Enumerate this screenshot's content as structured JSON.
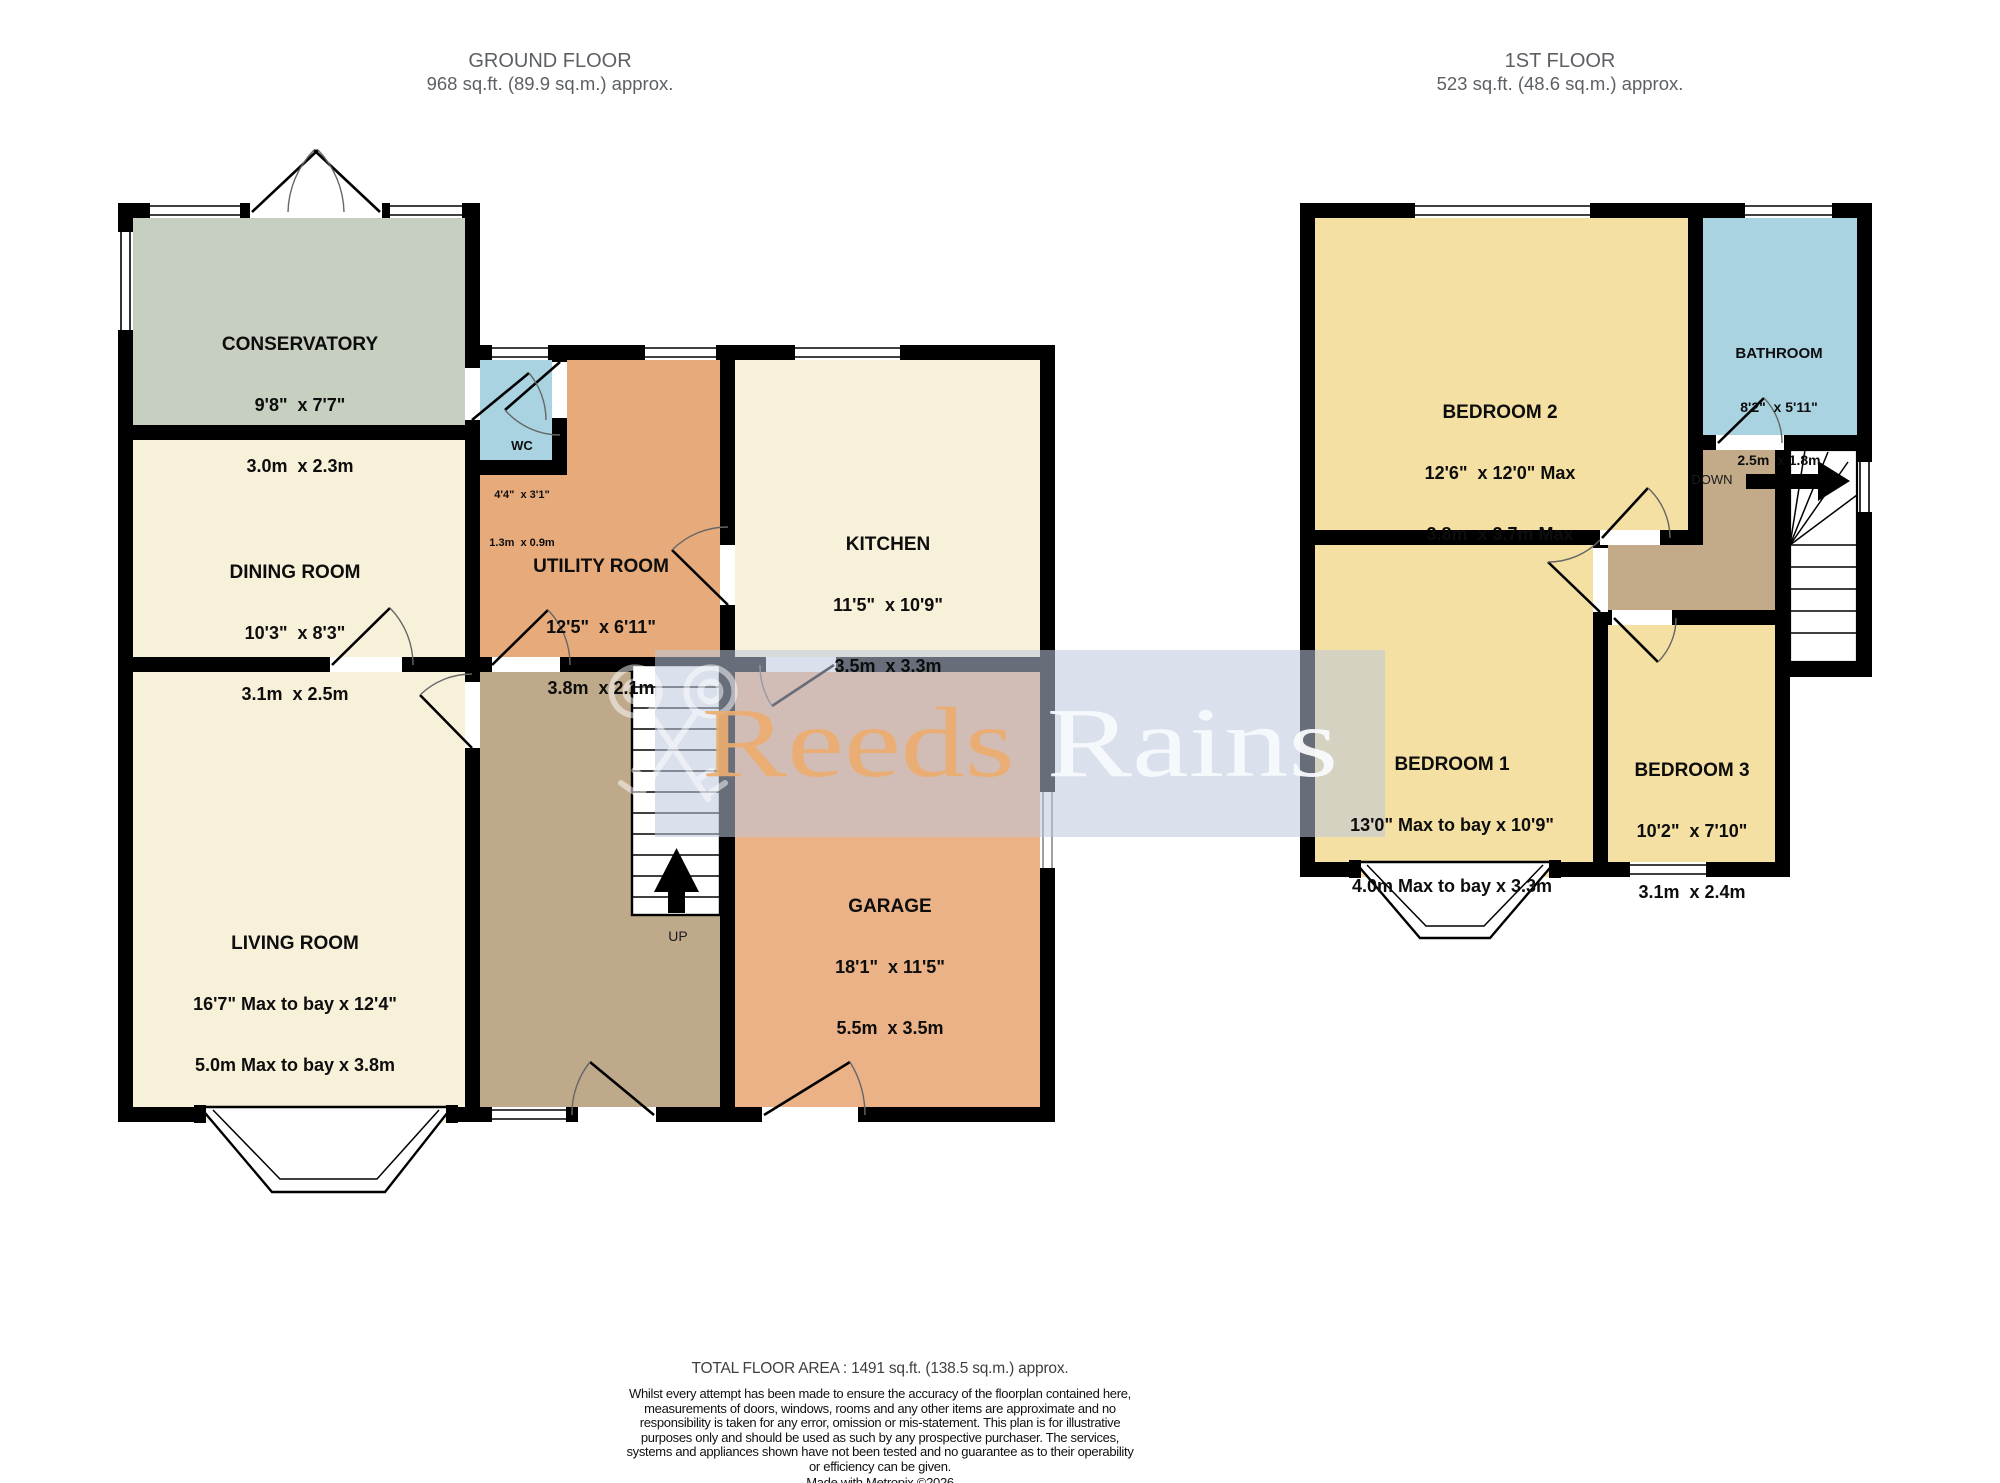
{
  "ground_floor": {
    "title": "GROUND FLOOR",
    "area": "968 sq.ft. (89.9 sq.m.) approx.",
    "stairs_label": "UP",
    "rooms": {
      "conservatory": {
        "name": "CONSERVATORY",
        "imperial": "9'8\"  x 7'7\"",
        "metric": "3.0m  x 2.3m"
      },
      "dining_room": {
        "name": "DINING ROOM",
        "imperial": "10'3\"  x 8'3\"",
        "metric": "3.1m  x 2.5m"
      },
      "wc": {
        "name": "WC",
        "imperial": "4'4\"  x 3'1\"",
        "metric": "1.3m  x 0.9m"
      },
      "utility_room": {
        "name": "UTILITY ROOM",
        "imperial": "12'5\"  x 6'11\"",
        "metric": "3.8m  x 2.1m"
      },
      "kitchen": {
        "name": "KITCHEN",
        "imperial": "11'5\"  x 10'9\"",
        "metric": "3.5m  x 3.3m"
      },
      "living_room": {
        "name": "LIVING ROOM",
        "imperial": "16'7\" Max to bay x 12'4\"",
        "metric": "5.0m Max to bay x 3.8m"
      },
      "garage": {
        "name": "GARAGE",
        "imperial": "18'1\"  x 11'5\"",
        "metric": "5.5m  x 3.5m"
      }
    }
  },
  "first_floor": {
    "title": "1ST FLOOR",
    "area": "523 sq.ft. (48.6 sq.m.) approx.",
    "stairs_label": "DOWN",
    "rooms": {
      "bedroom_2": {
        "name": "BEDROOM 2",
        "imperial": "12'6\"  x 12'0\" Max",
        "metric": "3.8m  x 3.7m Max"
      },
      "bathroom": {
        "name": "BATHROOM",
        "imperial": "8'2\"  x 5'11\"",
        "metric": "2.5m  x 1.8m"
      },
      "bedroom_1": {
        "name": "BEDROOM 1",
        "imperial": "13'0\" Max to bay x 10'9\"",
        "metric": "4.0m Max to bay x 3.3m"
      },
      "bedroom_3": {
        "name": "BEDROOM 3",
        "imperial": "10'2\"  x 7'10\"",
        "metric": "3.1m  x 2.4m"
      }
    }
  },
  "watermark": {
    "brand_first": "Reeds",
    "brand_second": "Rains"
  },
  "footer": {
    "total_area": "TOTAL FLOOR AREA : 1491 sq.ft. (138.5 sq.m.) approx.",
    "disclaimer": "Whilst every attempt has been made to ensure the accuracy of the floorplan contained here, measurements of doors, windows, rooms and any other items are approximate and no responsibility is taken for any error, omission or mis-statement. This plan is for illustrative purposes only and should be used as such by any prospective purchaser. The services, systems and appliances shown have not been tested and no guarantee as to their operability or efficiency can be given.",
    "credit": "Made with Metropix ©2026"
  },
  "colors": {
    "cream": "#f8f1da",
    "sage": "#c7cfc0",
    "utility_orange": "#e7ab7b",
    "garage_orange": "#eab286",
    "hall_tan": "#bfa98b",
    "landing_tan": "#c3ab8a",
    "bath_blue": "#a9d3e1",
    "bedroom_yellow": "#f4e0a2",
    "wall_black": "#000000",
    "banner_blue": "#bcc7dd",
    "brand_orange": "#ecac70"
  }
}
